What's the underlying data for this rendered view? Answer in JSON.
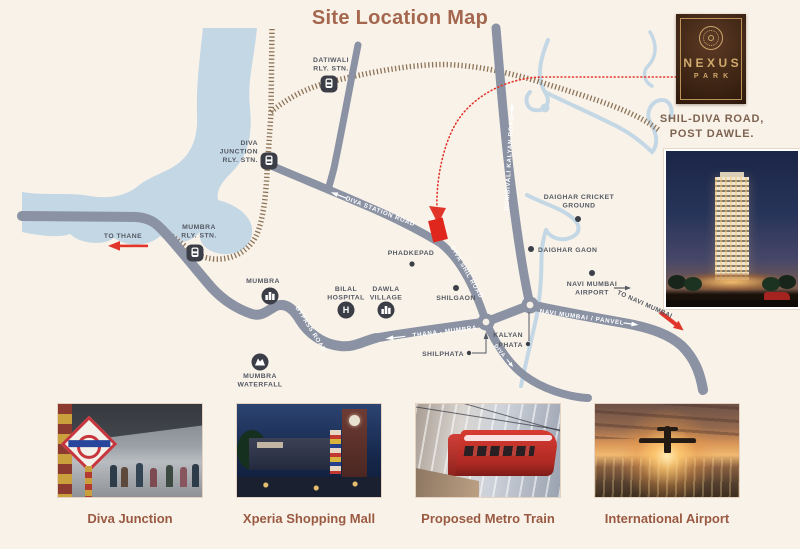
{
  "title": "Site Location Map",
  "logo": {
    "name": "NEXUS",
    "sub": "PARK",
    "address_line1": "SHIL-DIVA ROAD,",
    "address_line2": "POST DAWLE."
  },
  "colors": {
    "background": "#f9f2e9",
    "title_brown": "#a4674d",
    "road_gray": "#8a92a3",
    "river_blue": "#c4d7e5",
    "railway_brown": "#8d7458",
    "map_label_gray": "#545963",
    "accent_red": "#e2352a",
    "logo_brown": "#3c2414",
    "logo_gold": "#cda66a",
    "caption_brown": "#9a5a42"
  },
  "map": {
    "labels": {
      "datiwali_l1": "DATIWALI",
      "datiwali_l2": "RLY. STN.",
      "diva_jn_l1": "DIVA",
      "diva_jn_l2": "JUNCTION",
      "diva_jn_l3": "RLY. STN.",
      "mumbra_stn_l1": "MUMBRA",
      "mumbra_stn_l2": "RLY. STN.",
      "mumbra": "MUMBRA",
      "bilal_l1": "BILAL",
      "bilal_l2": "HOSPITAL",
      "dawla_l1": "DAWLA",
      "dawla_l2": "VILLAGE",
      "phadkepad": "PHADKEPAD",
      "shilgaon": "SHILGAON",
      "cricket_l1": "DAIGHAR CRICKET",
      "cricket_l2": "GROUND",
      "daighar_gaon": "DAIGHAR GAON",
      "airport_l1": "NAVI MUMBAI",
      "airport_l2": "AIRPORT",
      "kalyan_l1": "KALYAN",
      "kalyan_l2": "PHATA",
      "shilphata": "SHILPHATA",
      "waterfall_l1": "MUMBRA",
      "waterfall_l2": "WATERFALL",
      "to_thane": "TO THANE",
      "to_navi_mumbai": "TO NAVI MUMBAI",
      "road_diva_station": "DIVA STATION ROAD",
      "road_diva_shil": "DIVA SHIL ROAD",
      "road_dombivali": "DOMBIVALI KALYAN ROAD",
      "road_thana_mumbra": "THANA - MUMBRA",
      "road_navi_panvel": "NAVI MUMBAI / PANVEL",
      "road_bypass": "BYPASS ROAD",
      "road_diva_s": "DIVA"
    }
  },
  "gallery": [
    {
      "caption": "Diva Junction"
    },
    {
      "caption": "Xperia Shopping Mall"
    },
    {
      "caption": "Proposed Metro Train"
    },
    {
      "caption": "International Airport"
    }
  ]
}
